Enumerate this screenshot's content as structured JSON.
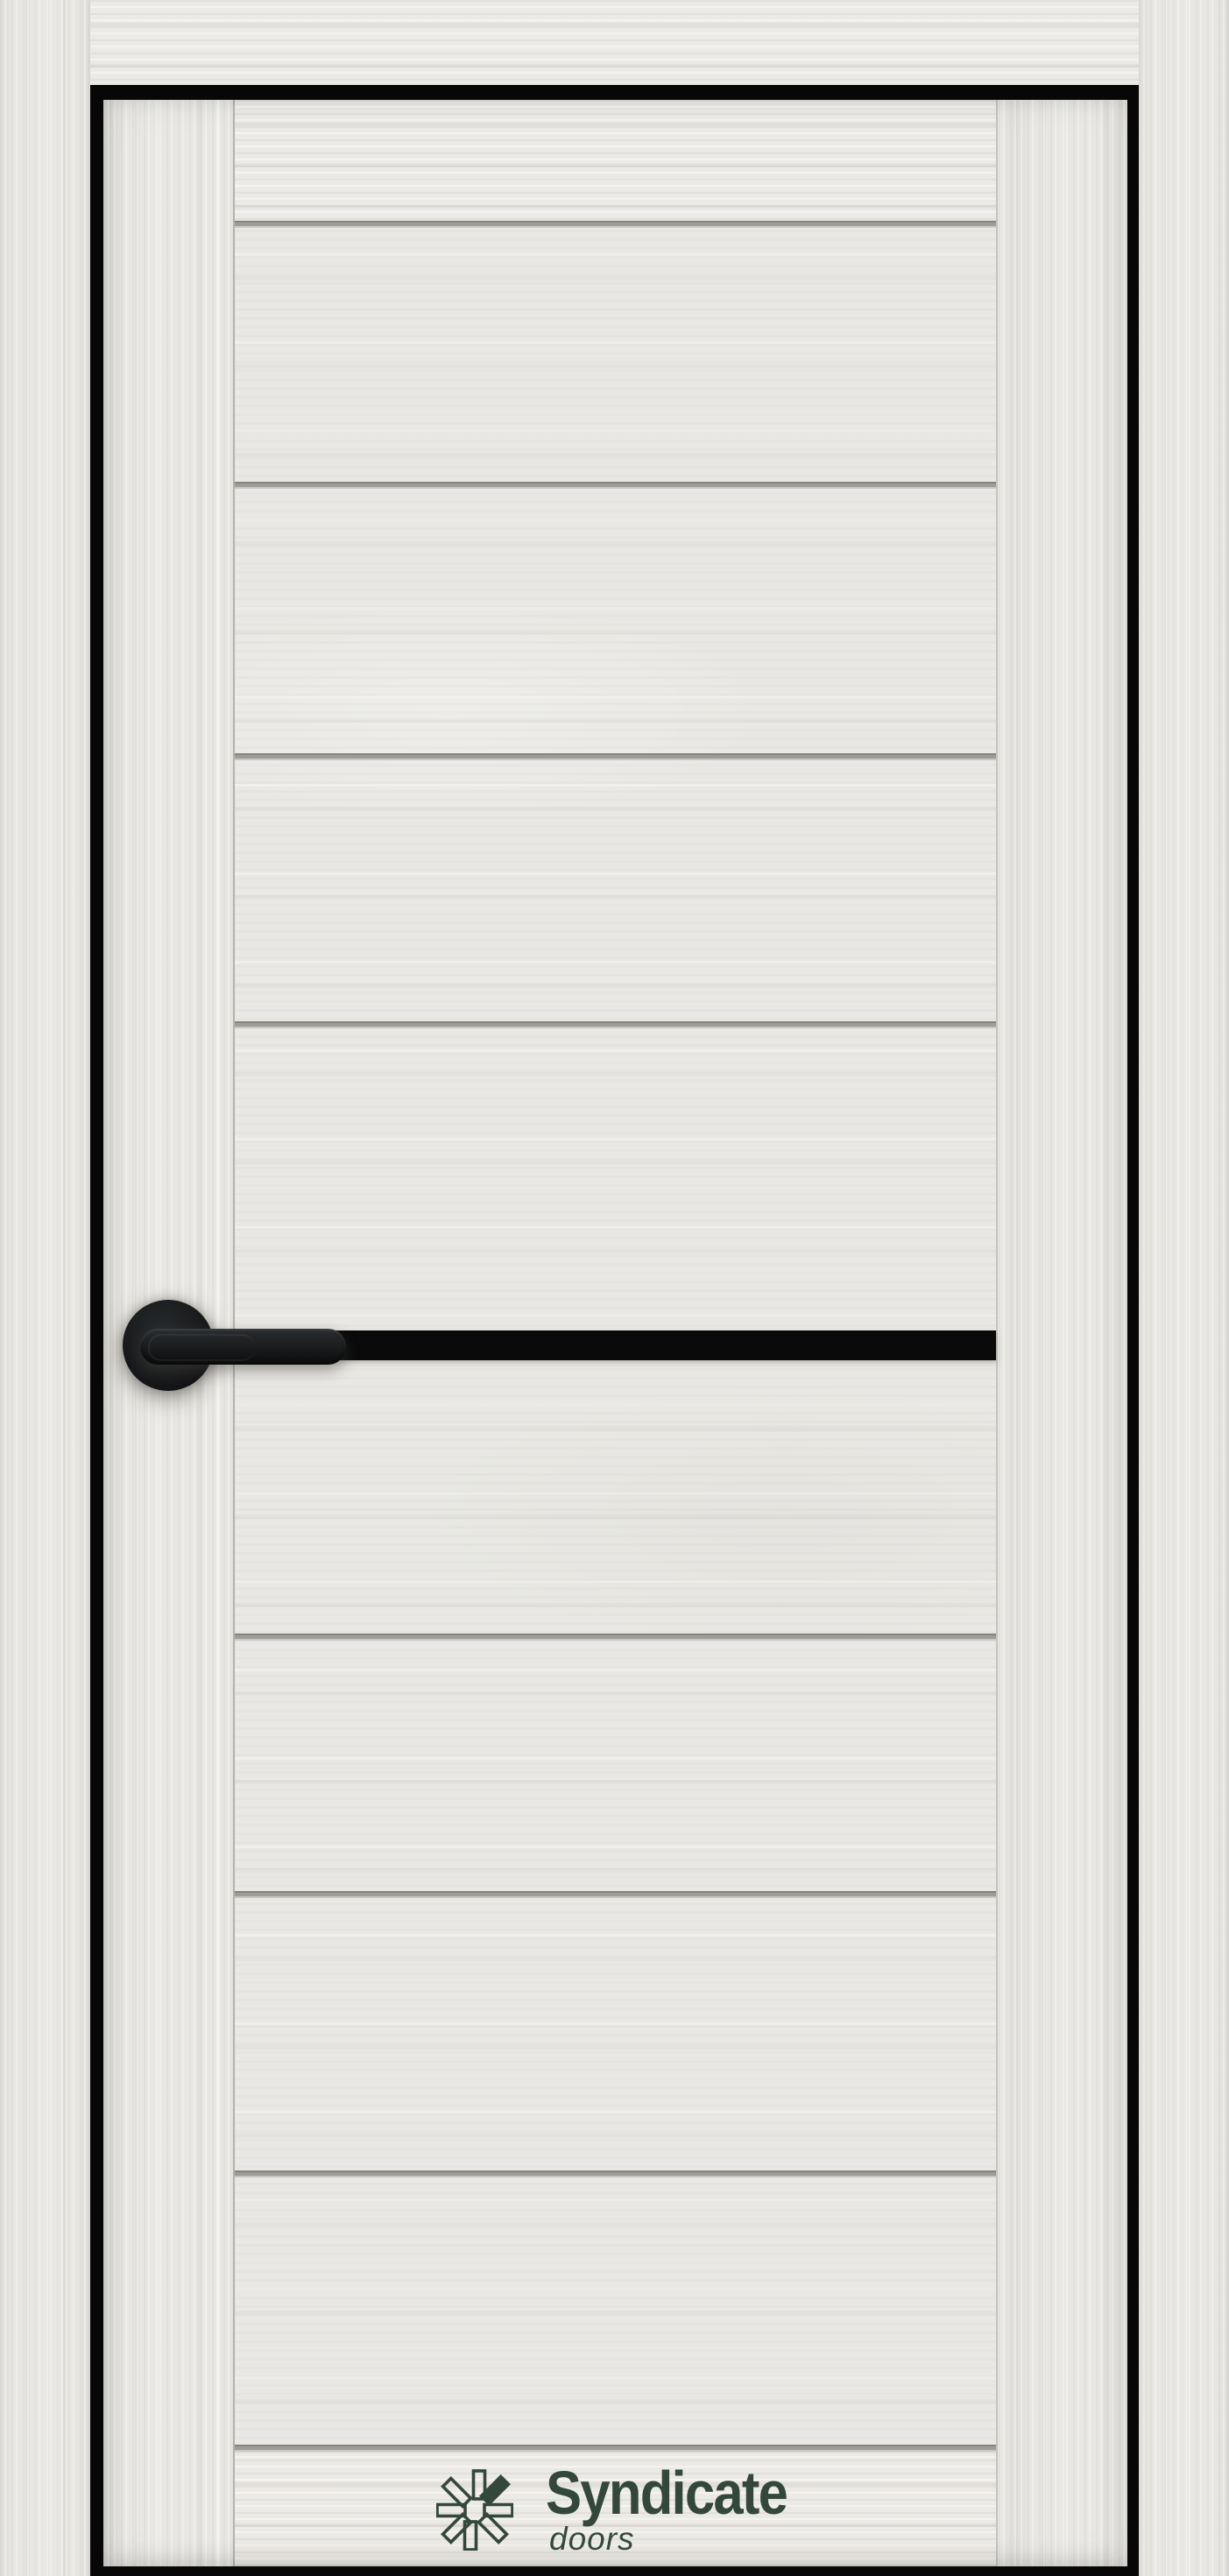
{
  "brand": {
    "name": "Syndicate",
    "tagline": "doors"
  },
  "logo": {
    "icon": "pinwheel-petals-icon",
    "petal_count": 8,
    "filled_petal_position": "top-right",
    "color": "#33483b"
  },
  "door": {
    "finish_color": "#e9e8e4",
    "groove_count": 8,
    "insert": "black horizontal stripe at handle level",
    "hardware": "black lever handle on round rosette"
  },
  "colors": {
    "stripe_black": "#0a0a0b",
    "gap_black": "#070708",
    "groove_gray": "#9d9c96",
    "handle_black": "#1b1d1f"
  }
}
